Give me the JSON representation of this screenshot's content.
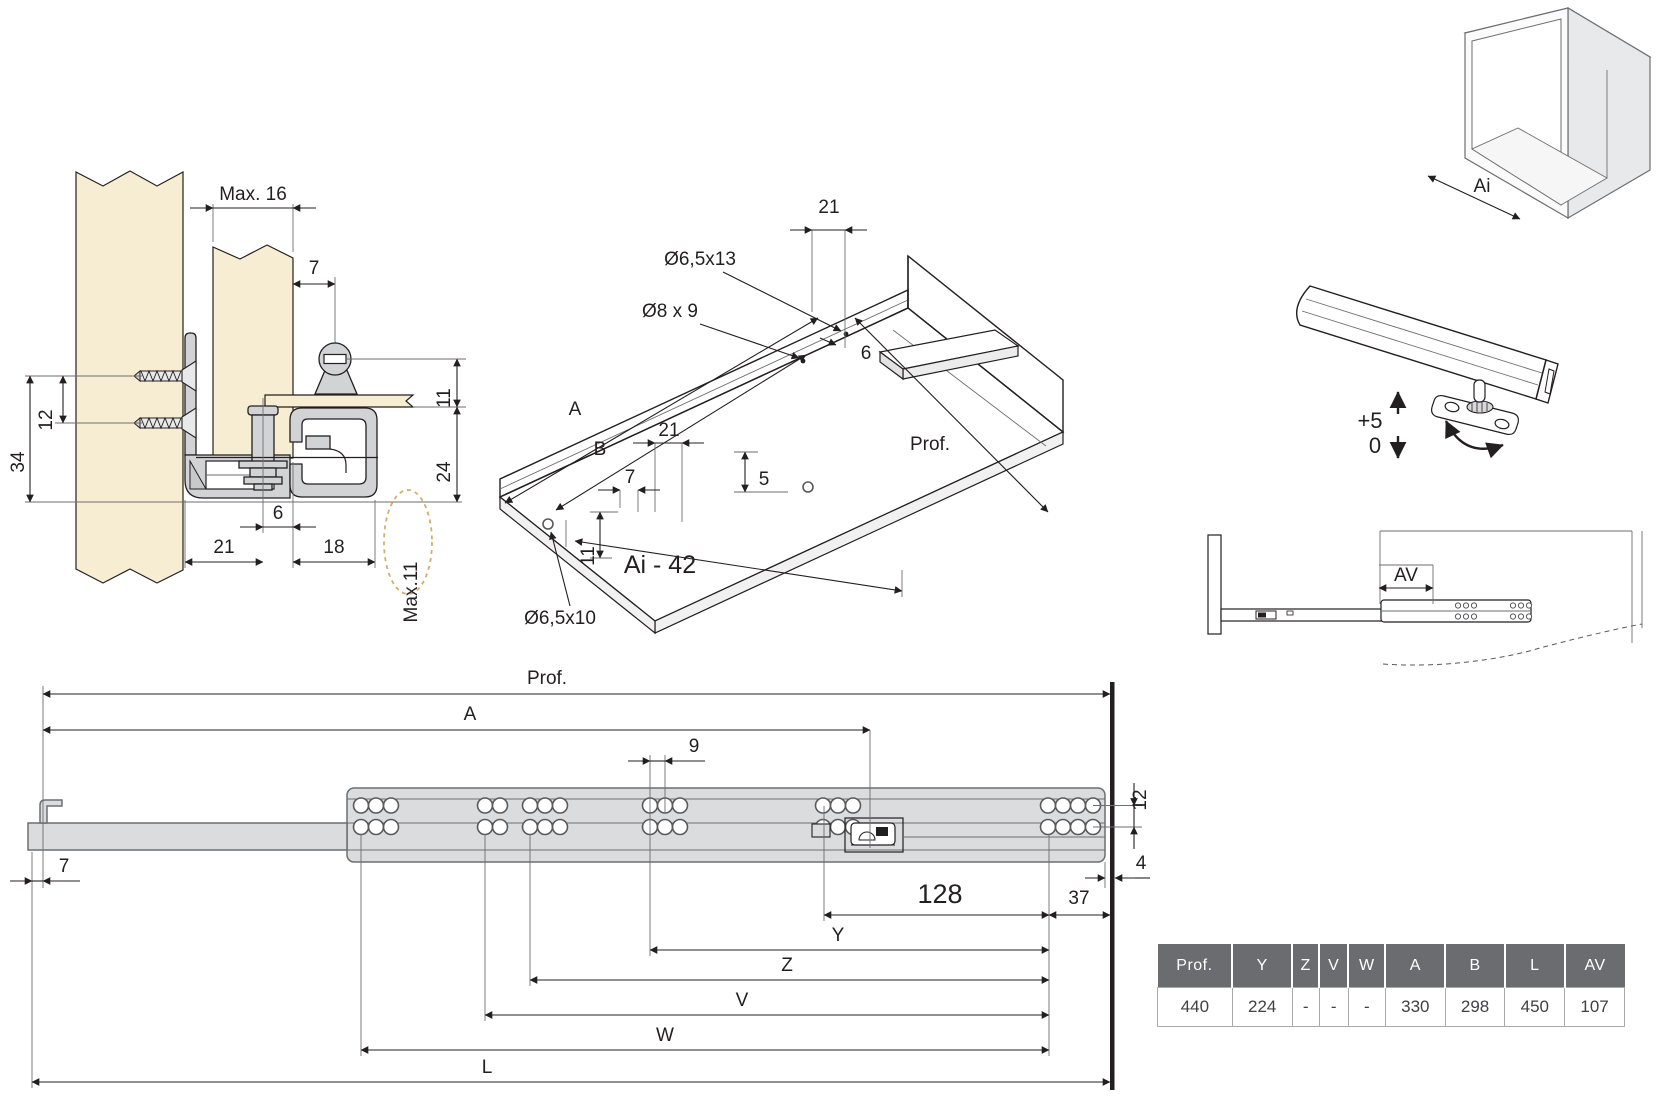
{
  "section_view": {
    "max16": "Max. 16",
    "d7": "7",
    "d12": "12",
    "d34": "34",
    "d11": "11",
    "d24": "24",
    "d6": "6",
    "d21": "21",
    "d18": "18",
    "max11": "Max.11"
  },
  "drawer_view": {
    "d21_top": "21",
    "hole_slot": "Ø6,5x13",
    "hole_pilot": "Ø8 x 9",
    "d6": "6",
    "a": "A",
    "b": "B",
    "d21": "21",
    "d7": "7",
    "d5": "5",
    "d11": "11",
    "hole_front": "Ø6,5x10",
    "prof": "Prof.",
    "width_formula": "Ai - 42"
  },
  "cabinet_view": {
    "ai": "Ai"
  },
  "adjustment_view": {
    "up": "+5",
    "down": "0"
  },
  "extension_view": {
    "av": "AV"
  },
  "side_view": {
    "prof": "Prof.",
    "a": "A",
    "d9": "9",
    "d7": "7",
    "d12": "12",
    "d4": "4",
    "d128": "128",
    "d37": "37",
    "y": "Y",
    "z": "Z",
    "v": "V",
    "w": "W",
    "l": "L"
  },
  "table": {
    "headers": [
      "Prof.",
      "Y",
      "Z",
      "V",
      "W",
      "A",
      "B",
      "L",
      "AV"
    ],
    "values": [
      "440",
      "224",
      "-",
      "-",
      "-",
      "330",
      "298",
      "450",
      "107"
    ]
  },
  "colors": {
    "wood": "#f7edd3",
    "metal": "#d2d3d4",
    "rail": "#dbdcdd",
    "outline": "#231f20",
    "thin_line": "#6d6e71",
    "dashed_highlight": "#d4af6a",
    "table_header_bg": "#6b6c6f",
    "table_header_text": "#ffffff",
    "table_cell_text": "#414042",
    "table_border": "#a7a9ac"
  }
}
